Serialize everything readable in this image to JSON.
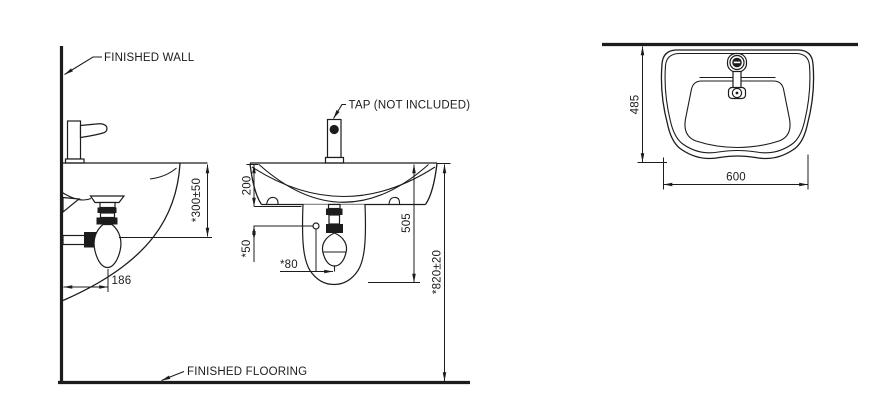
{
  "drawing": {
    "labels": {
      "finished_wall": "FINISHED WALL",
      "finished_flooring": "FINISHED FLOORING",
      "tap_note": "TAP (NOT INCLUDED)"
    },
    "side_view": {
      "rim_to_outlet_height": "*300±50",
      "outlet_from_wall": "186"
    },
    "front_view": {
      "basin_height": "200",
      "fixing_hole_offset": "*50",
      "outlet_center_offset": "*80",
      "basin_pedestal_height": "505",
      "rim_height_from_floor": "*820±20"
    },
    "top_view": {
      "basin_depth": "485",
      "basin_width": "600"
    },
    "colors": {
      "line": "#1c1c1c",
      "background": "#ffffff"
    }
  }
}
